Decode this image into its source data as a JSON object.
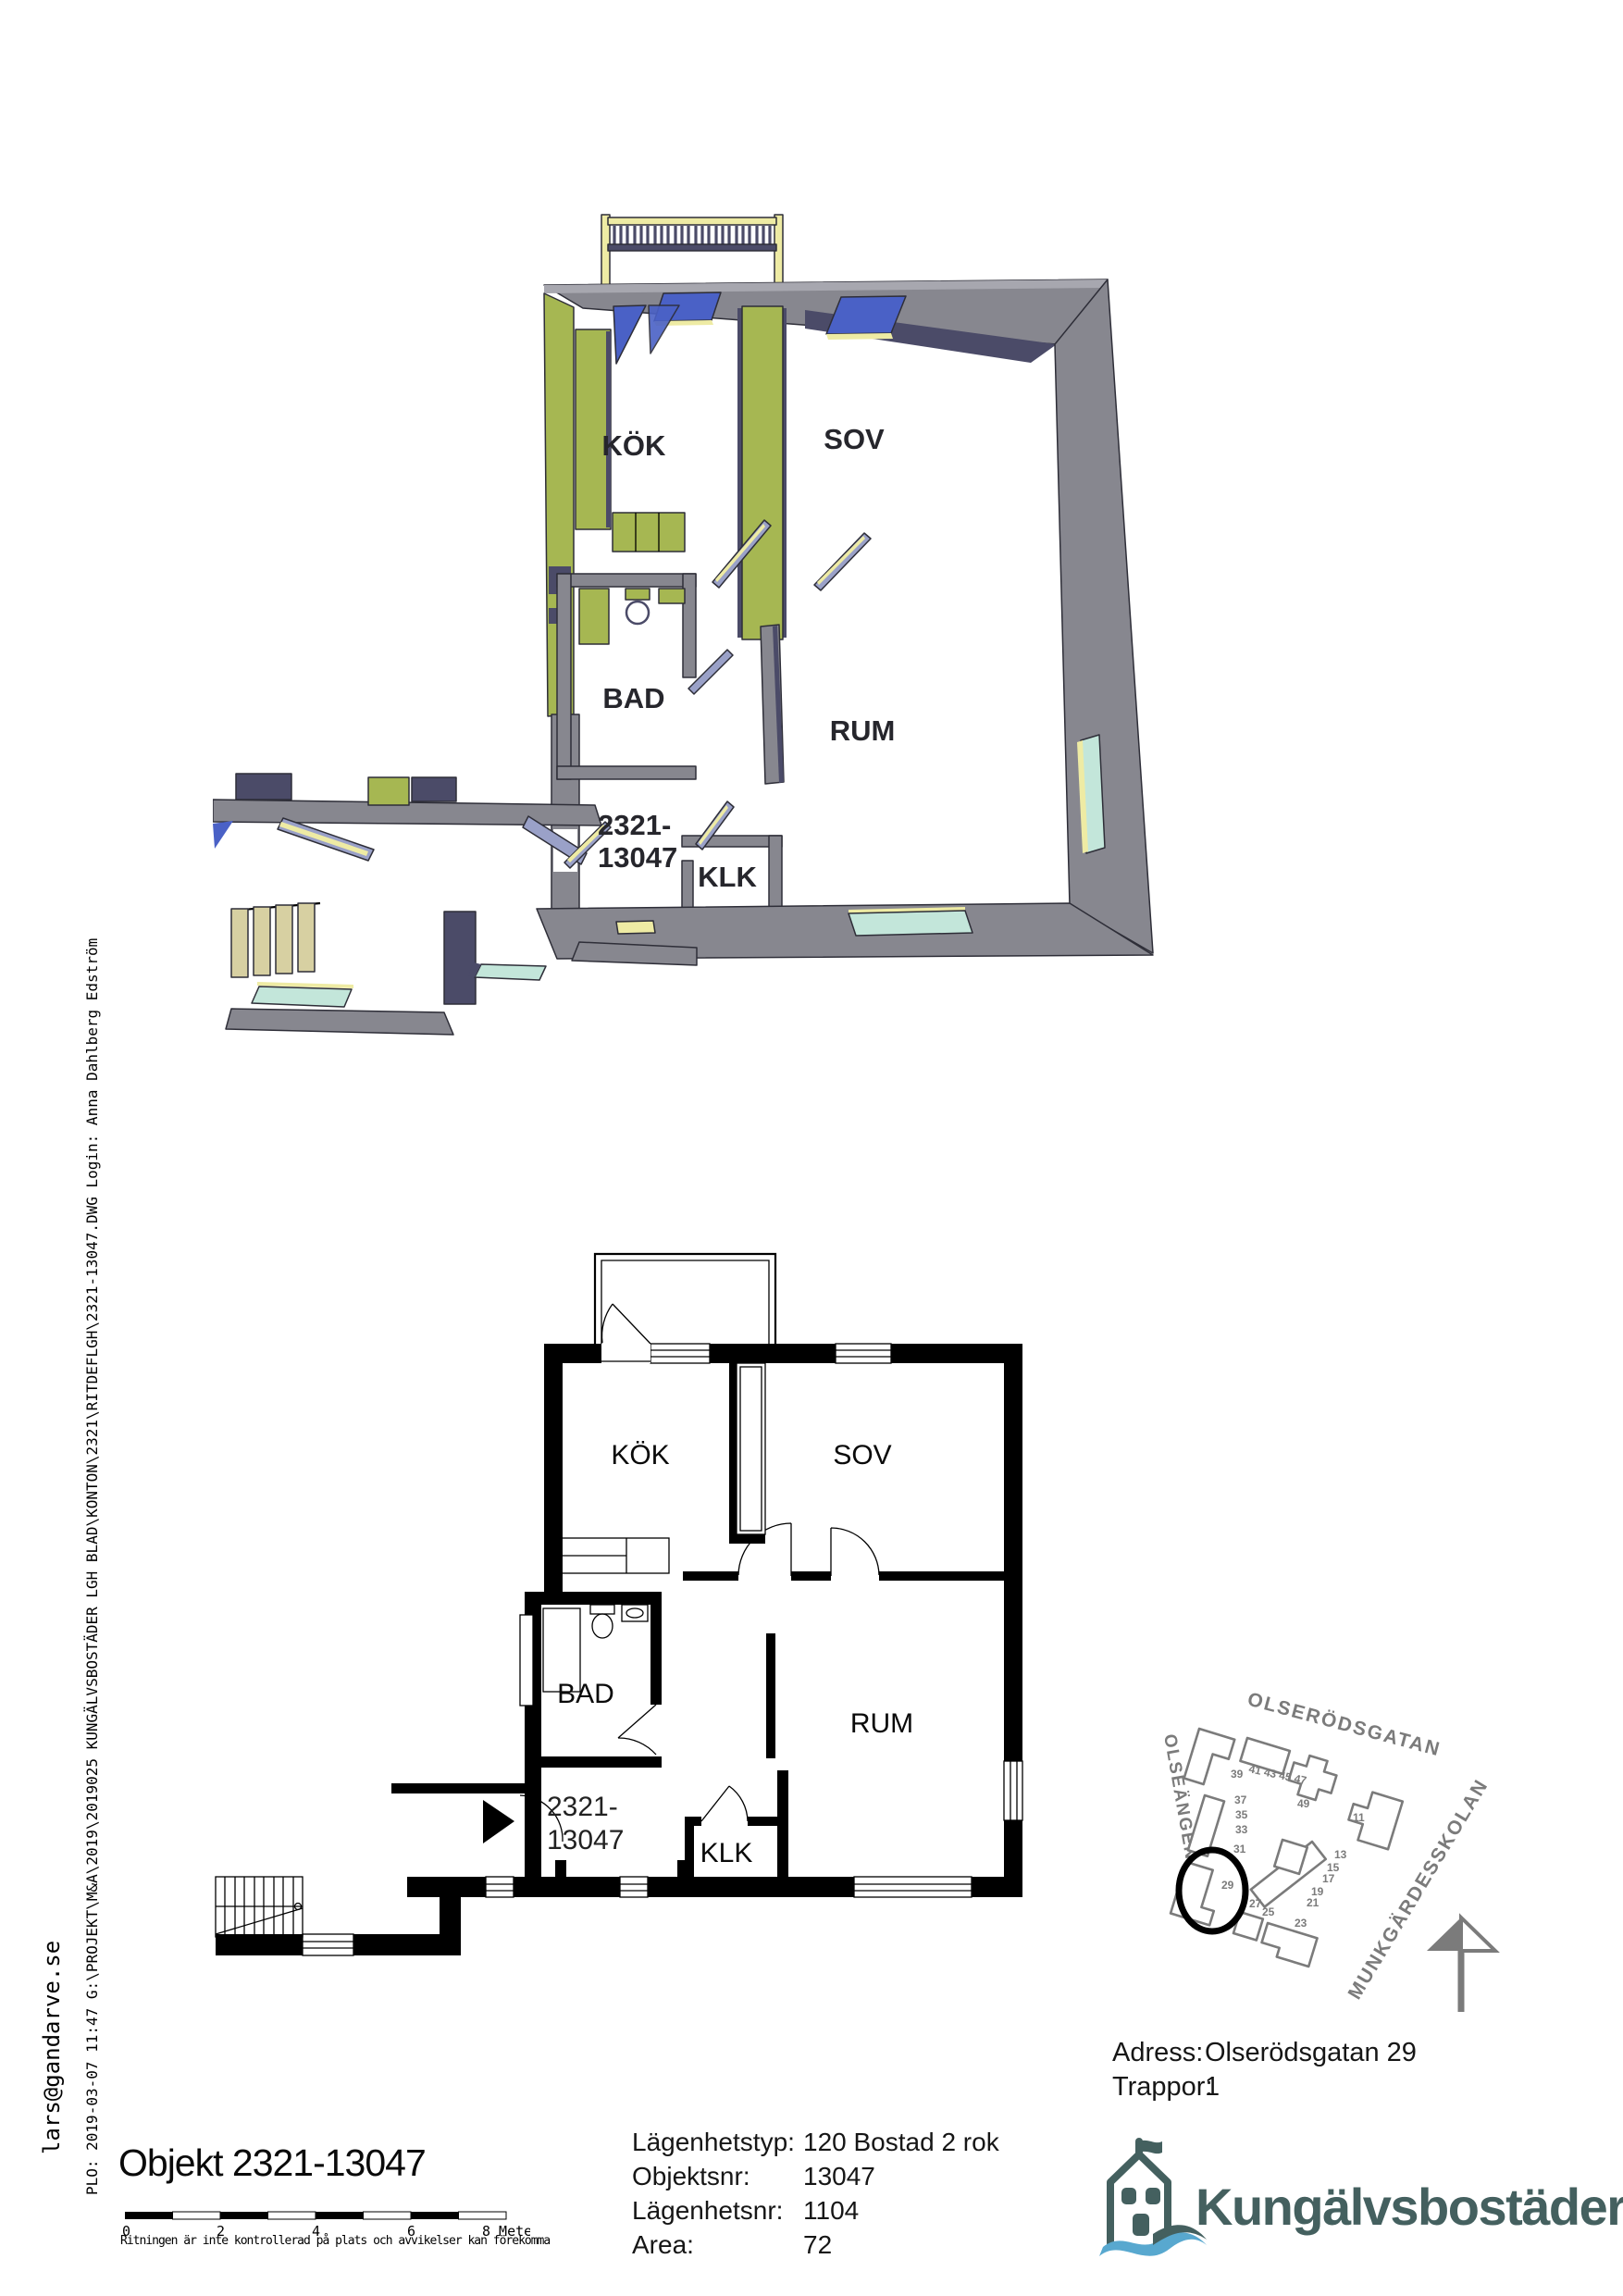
{
  "sidebar": {
    "email": "lars@gandarve.se",
    "plot_line": "PLO:  2019-03-07  11:47      G:\\PROJEKT\\M&A\\2019\\2019025 KUNGÄLVSBOSTÄDER LGH BLAD\\KONTON\\2321\\RITDEFLGH\\2321-13047.DWG Login: Anna Dahlberg Edström"
  },
  "rooms": {
    "kok": "KÖK",
    "sov": "SOV",
    "bad": "BAD",
    "rum": "RUM",
    "klk": "KLK"
  },
  "unit": {
    "line1": "2321-",
    "line2": "13047"
  },
  "sitemap": {
    "street_top": "OLSERÖDSGATAN",
    "street_left": "OLSEÄNGEN",
    "school": "MUNKGÄRDESSKOLAN",
    "numbers": [
      "39",
      "41 43 45 47",
      "49",
      "11",
      "37",
      "35",
      "33",
      "31",
      "29",
      "27",
      "25",
      "23",
      "13",
      "15",
      "17",
      "19",
      "21"
    ]
  },
  "footer": {
    "title": "Objekt 2321-13047",
    "scale": {
      "ticks": [
        "0",
        "2",
        "4",
        "6"
      ],
      "end": "8 Meter"
    },
    "disclaimer": "Ritningen är inte kontrollerad på plats och avvikelser kan förekomma"
  },
  "info": {
    "rows": [
      {
        "label": "Lägenhetstyp:",
        "value": "120 Bostad 2 rok"
      },
      {
        "label": "Objektsnr:",
        "value": "13047"
      },
      {
        "label": "Lägenhetsnr:",
        "value": "1104"
      },
      {
        "label": "Area:",
        "value": "72"
      }
    ]
  },
  "address": {
    "rows": [
      {
        "label": "Adress:",
        "value": "Olserödsgatan 29"
      },
      {
        "label": "Trappor:",
        "value": "1"
      }
    ]
  },
  "brand": {
    "name": "Kungälvsbostäder"
  },
  "colors": {
    "wall": "#87878f",
    "wallLight": "#a7a7af",
    "navy": "#4b4b68",
    "green": "#a6b752",
    "blue": "#4a61c6",
    "yellow": "#eeeba4",
    "cyan": "#c3e6da",
    "slate": "#9aa1c8",
    "tan": "#d7d0a2",
    "ink": "#2e2e38",
    "mapGray": "#7b7b7b",
    "brand": "#44605f",
    "wave": "#58a8cf"
  }
}
